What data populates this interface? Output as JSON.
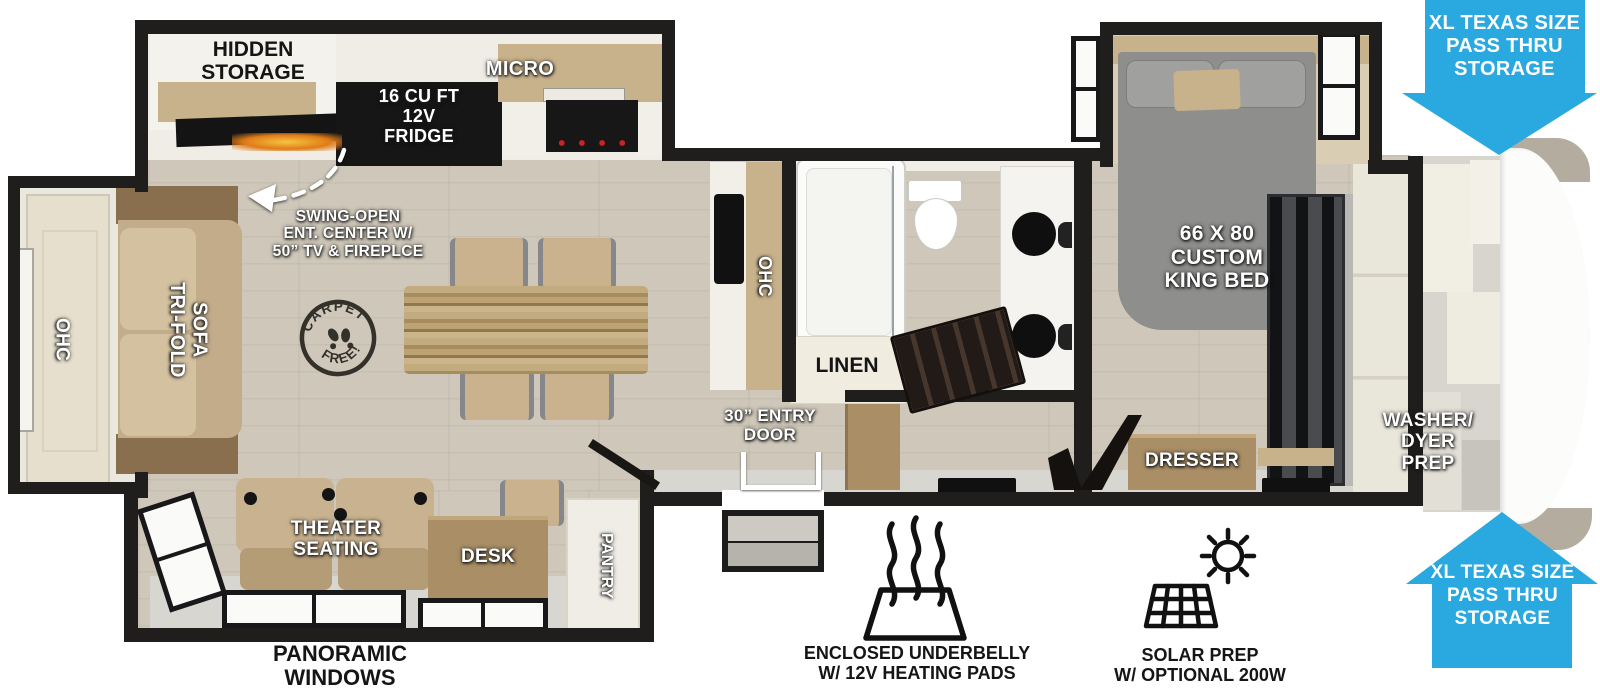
{
  "colors": {
    "arrow_blue": "#29a9e0",
    "wall": "#201e1c",
    "floor_wood": "#cfc8ba",
    "cabinet_tan": "#c8b28c",
    "bed_gray": "#8e8e8c",
    "flame_orange": "#e8962a"
  },
  "kitchen": {
    "hidden_storage": "HIDDEN\nSTORAGE",
    "fridge": "16 CU FT\n12V\nFRIDGE",
    "micro": "MICRO",
    "ent_center": "SWING-OPEN\nENT. CENTER W/\n50” TV & FIREPLCE",
    "ohc": "OHC"
  },
  "living": {
    "ohc": "OHC",
    "sofa": "TRI-FOLD\nSOFA",
    "carpet_stamp": {
      "top": "CARPET",
      "bottom": "FREE!"
    },
    "theater": "THEATER\nSEATING",
    "desk": "DESK",
    "pantry": "PANTRY"
  },
  "bath": {
    "linen": "LINEN"
  },
  "entry": {
    "door": "30” ENTRY\nDOOR"
  },
  "bedroom": {
    "bed": "66 X 80\nCUSTOM\nKING BED",
    "dresser": "DRESSER",
    "washer": "WASHER/\nDYER\nPREP"
  },
  "callouts": {
    "pass_thru_top": "XL TEXAS SIZE\nPASS THRU\nSTORAGE",
    "pass_thru_bottom": "XL TEXAS SIZE\nPASS THRU\nSTORAGE",
    "underbelly": "ENCLOSED UNDERBELLY\nW/ 12V HEATING PADS",
    "solar": "SOLAR PREP\nW/ OPTIONAL 200W\nSOLAR PACKAGE",
    "panoramic": "PANORAMIC\nWINDOWS"
  }
}
